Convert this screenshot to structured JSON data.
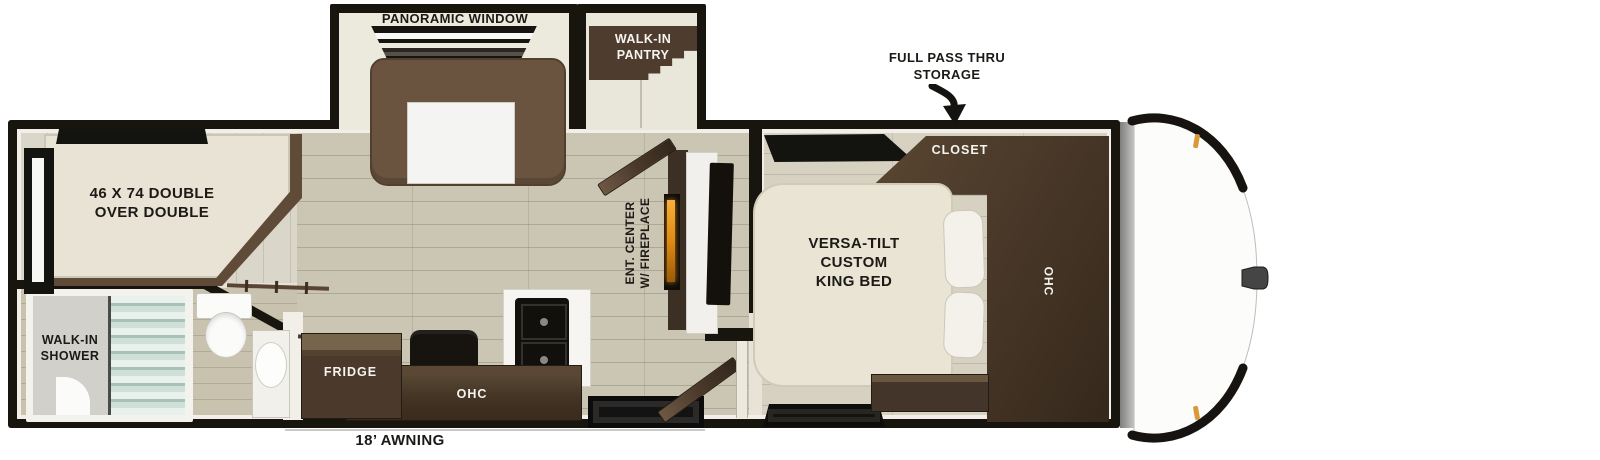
{
  "labels": {
    "panoramic_window": "PANORAMIC WINDOW",
    "walk_in_pantry": "WALK-IN\nPANTRY",
    "full_pass_thru_storage": "FULL PASS THRU\nSTORAGE",
    "bunk_bed": "46 X 74 DOUBLE\nOVER DOUBLE",
    "walk_in_shower": "WALK-IN\nSHOWER",
    "fridge": "FRIDGE",
    "kitchen_ohc": "OHC",
    "ent_center": "ENT. CENTER\nW/ FIREPLACE",
    "king_bed": "VERSA-TILT\nCUSTOM\nKING BED",
    "closet": "CLOSET",
    "bedroom_ohc": "OHC",
    "awning": "18’ AWNING"
  },
  "colors": {
    "wall_black": "#18150f",
    "floor_wood": "#cbc5b3",
    "floor_light": "#d6d1c1",
    "cabinet_dark_brown": "#47382a",
    "sofa_brown": "#6b543f",
    "bed_cream": "#e9e4d4",
    "shower_glass": "#c9ddd5",
    "fireplace_flame": "#e89420",
    "marker_light_amber": "#d9993b",
    "cap_white": "#fcfcfb"
  }
}
